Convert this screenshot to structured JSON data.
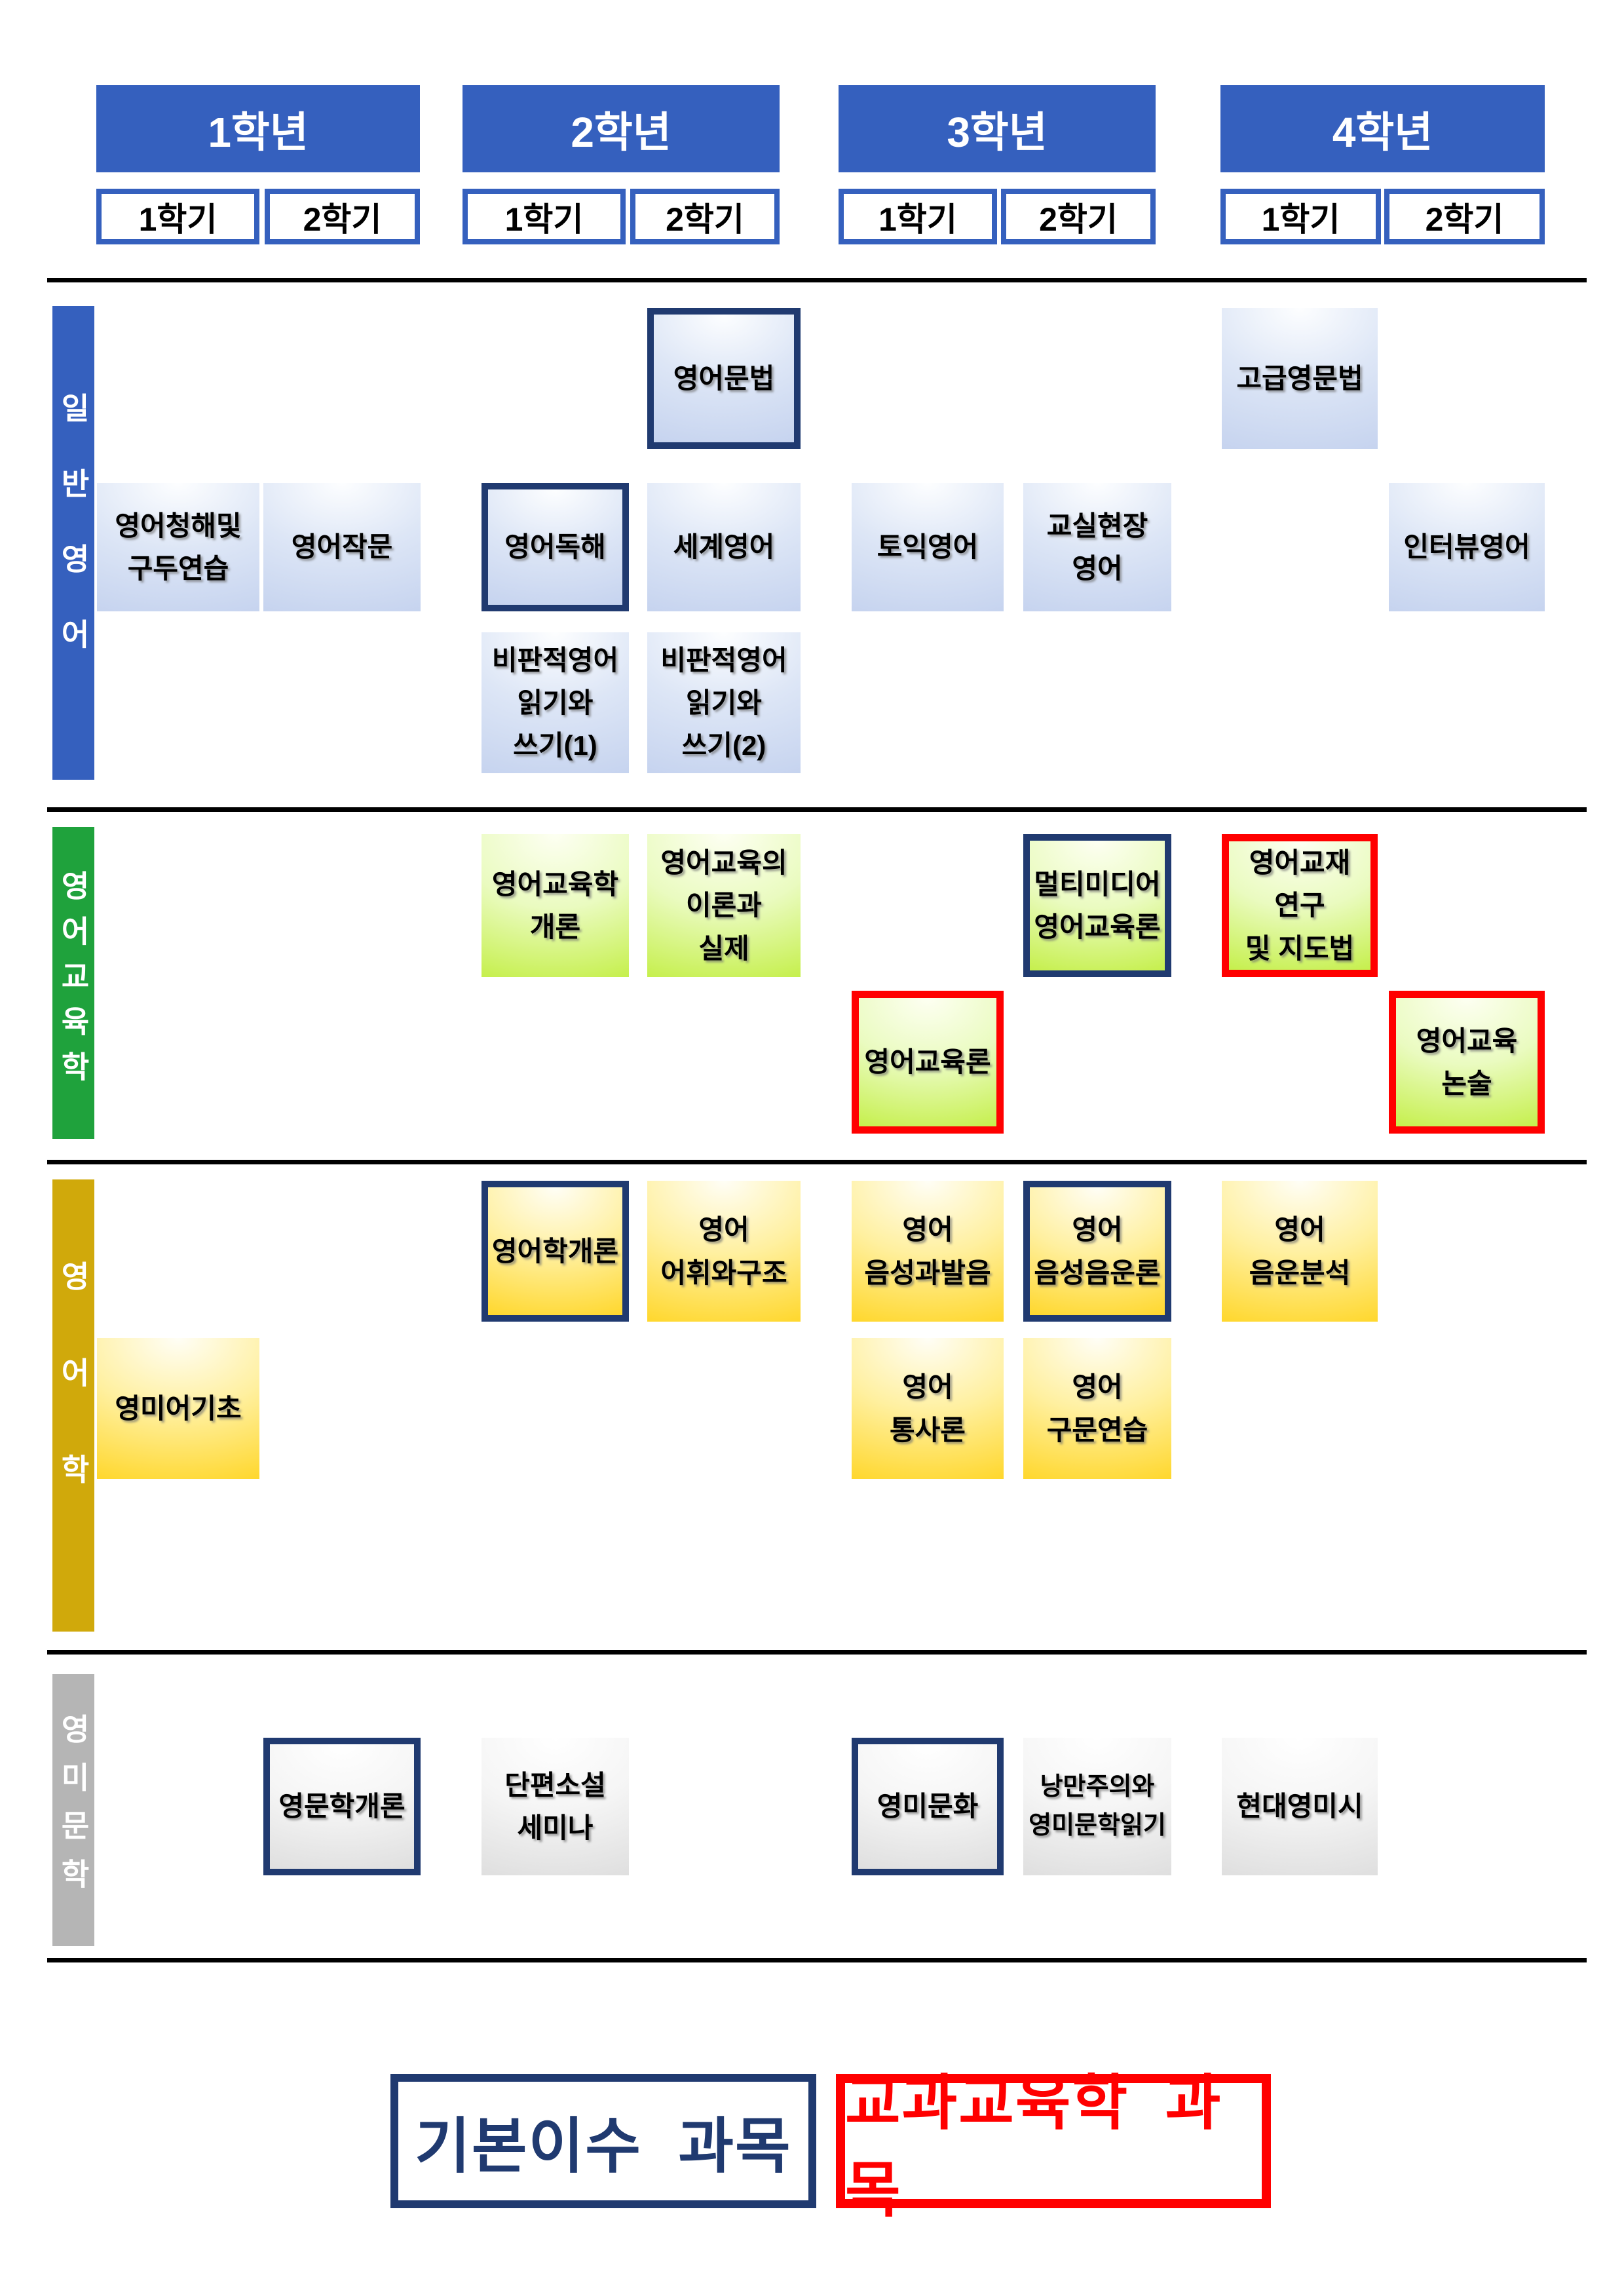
{
  "colors": {
    "header_blue": "#3560BE",
    "navy_border": "#203A70",
    "red_border": "#FF0000",
    "divider_black": "#000000"
  },
  "years": [
    {
      "label": "1학년",
      "semesters": [
        "1학기",
        "2학기"
      ]
    },
    {
      "label": "2학년",
      "semesters": [
        "1학기",
        "2학기"
      ]
    },
    {
      "label": "3학년",
      "semesters": [
        "1학기",
        "2학기"
      ]
    },
    {
      "label": "4학년",
      "semesters": [
        "1학기",
        "2학기"
      ]
    }
  ],
  "semester_labels": [
    "1학기",
    "2학기",
    "1학기",
    "2학기",
    "1학기",
    "2학기",
    "1학기",
    "2학기"
  ],
  "categories": [
    {
      "id": "general",
      "label": "일반영어",
      "bar_color": "#3560BE",
      "box_gradient": [
        "#FDFEFF",
        "#DDE6F6",
        "#C3D1EE"
      ]
    },
    {
      "id": "education",
      "label": "영어교육학",
      "bar_color": "#1FA23C",
      "box_gradient": [
        "#FDFFF2",
        "#EAFBC0",
        "#C1EE3E"
      ]
    },
    {
      "id": "linguistics",
      "label": "영어학",
      "bar_color": "#D0A90B",
      "box_gradient": [
        "#FFFEF6",
        "#FFF0A0",
        "#FFD41E"
      ]
    },
    {
      "id": "literature",
      "label": "영미문학",
      "bar_color": "#B5B5B5",
      "box_gradient": [
        "#FFFFFF",
        "#F5F5F5",
        "#DCDCDC"
      ]
    }
  ],
  "courses": [
    {
      "label": "영어문법",
      "category": "general",
      "year": 2,
      "semester": 2,
      "row": 0,
      "border": "navy"
    },
    {
      "label": "고급영문법",
      "category": "general",
      "year": 4,
      "semester": 1,
      "row": 0,
      "border": "none"
    },
    {
      "label": "영어청해및\n구두연습",
      "category": "general",
      "year": 1,
      "semester": 1,
      "row": 1,
      "border": "none"
    },
    {
      "label": "영어작문",
      "category": "general",
      "year": 1,
      "semester": 2,
      "row": 1,
      "border": "none"
    },
    {
      "label": "영어독해",
      "category": "general",
      "year": 2,
      "semester": 1,
      "row": 1,
      "border": "navy"
    },
    {
      "label": "세계영어",
      "category": "general",
      "year": 2,
      "semester": 2,
      "row": 1,
      "border": "none"
    },
    {
      "label": "토익영어",
      "category": "general",
      "year": 3,
      "semester": 1,
      "row": 1,
      "border": "none"
    },
    {
      "label": "교실현장\n영어",
      "category": "general",
      "year": 3,
      "semester": 2,
      "row": 1,
      "border": "none"
    },
    {
      "label": "인터뷰영어",
      "category": "general",
      "year": 4,
      "semester": 2,
      "row": 1,
      "border": "none"
    },
    {
      "label": "비판적영어\n읽기와\n쓰기(1)",
      "category": "general",
      "year": 2,
      "semester": 1,
      "row": 2,
      "border": "none"
    },
    {
      "label": "비판적영어\n읽기와\n쓰기(2)",
      "category": "general",
      "year": 2,
      "semester": 2,
      "row": 2,
      "border": "none"
    },
    {
      "label": "영어교육학\n개론",
      "category": "education",
      "year": 2,
      "semester": 1,
      "row": 0,
      "border": "none"
    },
    {
      "label": "영어교육의\n이론과\n실제",
      "category": "education",
      "year": 2,
      "semester": 2,
      "row": 0,
      "border": "none"
    },
    {
      "label": "멀티미디어\n영어교육론",
      "category": "education",
      "year": 3,
      "semester": 2,
      "row": 0,
      "border": "navy"
    },
    {
      "label": "영어교재\n연구\n및 지도법",
      "category": "education",
      "year": 4,
      "semester": 1,
      "row": 0,
      "border": "red"
    },
    {
      "label": "영어교육론",
      "category": "education",
      "year": 3,
      "semester": 1,
      "row": 1,
      "border": "red"
    },
    {
      "label": "영어교육\n논술",
      "category": "education",
      "year": 4,
      "semester": 2,
      "row": 1,
      "border": "red"
    },
    {
      "label": "영어학개론",
      "category": "linguistics",
      "year": 2,
      "semester": 1,
      "row": 0,
      "border": "navy"
    },
    {
      "label": "영어\n어휘와구조",
      "category": "linguistics",
      "year": 2,
      "semester": 2,
      "row": 0,
      "border": "none"
    },
    {
      "label": "영어\n음성과발음",
      "category": "linguistics",
      "year": 3,
      "semester": 1,
      "row": 0,
      "border": "none"
    },
    {
      "label": "영어\n음성음운론",
      "category": "linguistics",
      "year": 3,
      "semester": 2,
      "row": 0,
      "border": "navy"
    },
    {
      "label": "영어\n음운분석",
      "category": "linguistics",
      "year": 4,
      "semester": 1,
      "row": 0,
      "border": "none"
    },
    {
      "label": "영미어기초",
      "category": "linguistics",
      "year": 1,
      "semester": 1,
      "row": 1,
      "border": "none"
    },
    {
      "label": "영어\n통사론",
      "category": "linguistics",
      "year": 3,
      "semester": 1,
      "row": 1,
      "border": "none"
    },
    {
      "label": "영어\n구문연습",
      "category": "linguistics",
      "year": 3,
      "semester": 2,
      "row": 1,
      "border": "none"
    },
    {
      "label": "영문학개론",
      "category": "literature",
      "year": 1,
      "semester": 2,
      "row": 0,
      "border": "navy"
    },
    {
      "label": "단편소설\n세미나",
      "category": "literature",
      "year": 2,
      "semester": 1,
      "row": 0,
      "border": "none"
    },
    {
      "label": "영미문화",
      "category": "literature",
      "year": 3,
      "semester": 1,
      "row": 0,
      "border": "navy"
    },
    {
      "label": "낭만주의와\n영미문학읽기",
      "category": "literature",
      "year": 3,
      "semester": 2,
      "row": 0,
      "border": "none",
      "size": 38
    },
    {
      "label": "현대영미시",
      "category": "literature",
      "year": 4,
      "semester": 1,
      "row": 0,
      "border": "none"
    }
  ],
  "legend": {
    "items": [
      {
        "label": "기본이수 과목",
        "color": "#203A70"
      },
      {
        "label": "교과교육학 과목",
        "color": "#FF0000"
      }
    ]
  }
}
